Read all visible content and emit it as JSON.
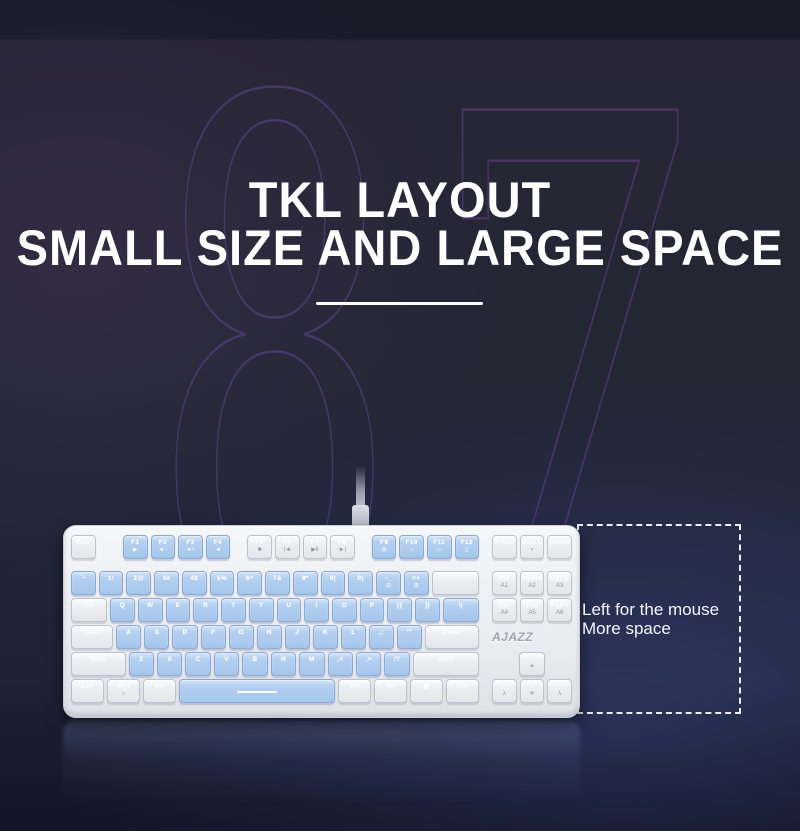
{
  "title": {
    "line1": "TKL LAYOUT",
    "line2": "SMALL SIZE AND LARGE SPACE"
  },
  "ghost_number": {
    "digit_left": "8",
    "digit_right": "7"
  },
  "annotation": {
    "line1": "Left for the mouse",
    "line2": "More space"
  },
  "colors": {
    "background_navy": "#20243a",
    "top_band": "#191b29",
    "ghost_purple": "#5c4696",
    "key_blue": "#aac9ec",
    "key_white": "#ededf1",
    "case_white": "#eef0f3",
    "headline_white": "#ffffff",
    "dashed_line": "#e9edf5"
  },
  "keyboard": {
    "brand": "AJAZZ",
    "main_rows": [
      [
        {
          "l": "Esc",
          "c": "w"
        },
        {
          "sp": 0.95
        },
        {
          "l": "F1",
          "s": "▶",
          "c": "b"
        },
        {
          "l": "F2",
          "s": "◄−",
          "c": "b"
        },
        {
          "l": "F3",
          "s": "◄+",
          "c": "b"
        },
        {
          "l": "F4",
          "s": "◄",
          "c": "b"
        },
        {
          "sp": 0.5
        },
        {
          "l": "F5",
          "s": "■",
          "c": "w"
        },
        {
          "l": "F6",
          "s": "|◄",
          "c": "w"
        },
        {
          "l": "F7",
          "s": "▶‖",
          "c": "w"
        },
        {
          "l": "F8",
          "s": "►|",
          "c": "w"
        },
        {
          "sp": 0.5
        },
        {
          "l": "F9",
          "s": "⊞",
          "c": "b"
        },
        {
          "l": "F10",
          "s": "⌂",
          "c": "b"
        },
        {
          "l": "F11",
          "s": "▭",
          "c": "b"
        },
        {
          "l": "F12",
          "s": "▯",
          "c": "b"
        }
      ],
      [
        {
          "l": "`~",
          "n": "grave",
          "c": "b"
        },
        {
          "l": "1!",
          "n": "1",
          "c": "b"
        },
        {
          "l": "2@",
          "n": "2",
          "c": "b"
        },
        {
          "l": "3#",
          "n": "3",
          "c": "b"
        },
        {
          "l": "4$",
          "n": "4",
          "c": "b"
        },
        {
          "l": "5%",
          "n": "5",
          "c": "b"
        },
        {
          "l": "6^",
          "n": "6",
          "c": "b"
        },
        {
          "l": "7&",
          "n": "7",
          "c": "b"
        },
        {
          "l": "8*",
          "n": "8",
          "c": "b"
        },
        {
          "l": "9(",
          "n": "9",
          "c": "b"
        },
        {
          "l": "0)",
          "n": "0",
          "c": "b"
        },
        {
          "l": "-_",
          "n": "minus",
          "s": "⊟",
          "c": "b"
        },
        {
          "l": "=+",
          "n": "equals",
          "s": "⊞",
          "c": "b"
        },
        {
          "l": "←",
          "n": "backspace",
          "c": "w",
          "u": 2
        }
      ],
      [
        {
          "l": "Tab",
          "c": "w",
          "u": 1.5
        },
        {
          "l": "Q",
          "c": "b"
        },
        {
          "l": "W",
          "c": "b"
        },
        {
          "l": "E",
          "c": "b"
        },
        {
          "l": "R",
          "c": "b"
        },
        {
          "l": "T",
          "c": "b"
        },
        {
          "l": "Y",
          "c": "b"
        },
        {
          "l": "U",
          "c": "b"
        },
        {
          "l": "I",
          "c": "b"
        },
        {
          "l": "O",
          "c": "b"
        },
        {
          "l": "P",
          "c": "b"
        },
        {
          "l": "[{",
          "n": "lbracket",
          "c": "b"
        },
        {
          "l": "]}",
          "n": "rbracket",
          "c": "b"
        },
        {
          "l": "\\|",
          "n": "backslash",
          "c": "b",
          "u": 1.5
        }
      ],
      [
        {
          "l": "Caps",
          "c": "w",
          "u": 1.75
        },
        {
          "l": "A",
          "c": "b"
        },
        {
          "l": "S",
          "c": "b"
        },
        {
          "l": "D",
          "c": "b"
        },
        {
          "l": "F",
          "c": "b"
        },
        {
          "l": "G",
          "c": "b"
        },
        {
          "l": "H",
          "c": "b"
        },
        {
          "l": "J",
          "c": "b"
        },
        {
          "l": "K",
          "c": "b"
        },
        {
          "l": "L",
          "c": "b"
        },
        {
          "l": ";:",
          "n": "semicolon",
          "c": "b"
        },
        {
          "l": "'\"",
          "n": "quote",
          "c": "b"
        },
        {
          "l": "Enter",
          "c": "w",
          "u": 2.25
        }
      ],
      [
        {
          "l": "Shift",
          "c": "w",
          "u": 2.25
        },
        {
          "l": "Z",
          "c": "b"
        },
        {
          "l": "X",
          "c": "b"
        },
        {
          "l": "C",
          "c": "b"
        },
        {
          "l": "V",
          "c": "b"
        },
        {
          "l": "B",
          "c": "b"
        },
        {
          "l": "N",
          "c": "b"
        },
        {
          "l": "M",
          "c": "b"
        },
        {
          "l": ",<",
          "n": "comma",
          "c": "b"
        },
        {
          "l": ".>",
          "n": "period",
          "c": "b"
        },
        {
          "l": "/?",
          "n": "slash",
          "c": "b"
        },
        {
          "l": "Shift",
          "n": "right-shift",
          "c": "w",
          "u": 2.75
        }
      ],
      [
        {
          "l": "Ctrl",
          "c": "w",
          "u": 1.25
        },
        {
          "l": "Win",
          "s": "⌂",
          "c": "w",
          "u": 1.25
        },
        {
          "l": "Alt",
          "c": "w",
          "u": 1.25
        },
        {
          "n": "space",
          "bar": true,
          "c": "b",
          "u": 6.25
        },
        {
          "l": "Alt",
          "n": "right-alt",
          "c": "w",
          "u": 1.25
        },
        {
          "l": "Fn",
          "c": "w",
          "u": 1.25
        },
        {
          "l": "▤",
          "n": "menu",
          "c": "w",
          "u": 1.25
        },
        {
          "l": "Ctrl",
          "n": "right-ctrl",
          "c": "w",
          "u": 1.25
        }
      ]
    ],
    "nav_rows": [
      [
        {
          "l": "PrtSc",
          "c": "w"
        },
        {
          "l": "ScrLk",
          "s": "▪",
          "c": "w"
        },
        {
          "l": "Pause",
          "c": "w"
        }
      ],
      [
        {
          "l": "Ins",
          "s": "A1",
          "c": "w"
        },
        {
          "l": "Home",
          "s": "A2",
          "c": "w"
        },
        {
          "l": "PgUp",
          "s": "A3",
          "c": "w"
        }
      ],
      [
        {
          "l": "Del",
          "s": "A4",
          "c": "w"
        },
        {
          "l": "End",
          "s": "A5",
          "c": "w"
        },
        {
          "l": "PgDn",
          "s": "A6",
          "c": "w"
        }
      ],
      [
        {
          "logo": true
        }
      ],
      [
        {
          "sp": 1
        },
        {
          "l": "↑",
          "n": "up-arrow",
          "s": "☀",
          "c": "w"
        },
        {
          "sp": 1
        }
      ],
      [
        {
          "l": "←",
          "n": "left-arrow",
          "s": "λ",
          "c": "w"
        },
        {
          "l": "↓",
          "n": "down-arrow",
          "s": "☀",
          "c": "w"
        },
        {
          "l": "→",
          "n": "right-arrow",
          "s": "λ",
          "c": "w"
        }
      ]
    ]
  }
}
